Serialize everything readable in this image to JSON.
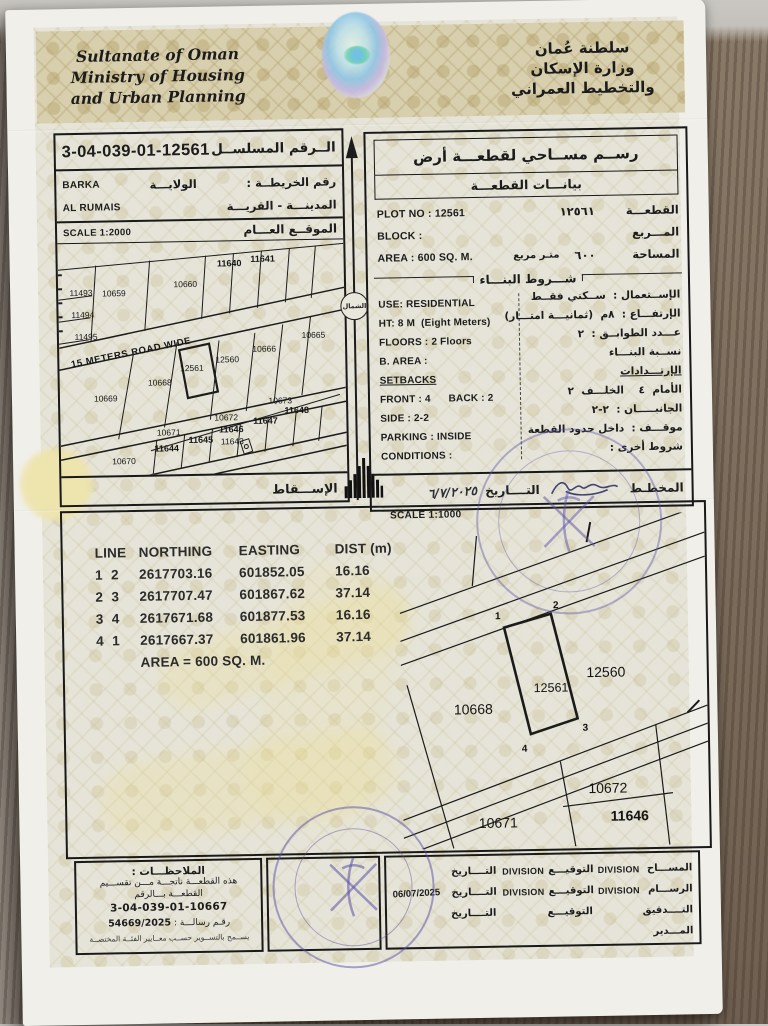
{
  "header": {
    "english_lines": [
      "Sultanate of Oman",
      "Ministry of Housing",
      "and Urban Planning"
    ],
    "arabic_lines": [
      "سلطنة عُمان",
      "وزارة الإسكان",
      "والتخطيط العمراني"
    ]
  },
  "serial_box": {
    "serial_label": "الــرقم المسلســل",
    "serial_value": "3-04-039-01-12561",
    "map_no_label": "رقم الخريطــة :",
    "wilaya_label": "الولايـــة",
    "wilaya_value": "BARKA",
    "town_label": "المدينـــة - القريـــة",
    "town_value": "AL RUMAIS"
  },
  "overview_map": {
    "title": "الموقــع العـــام",
    "scale": "SCALE 1:2000",
    "projection_label": "الإســـقاط",
    "north_label": "الشمال",
    "plots": [
      {
        "label": "11493",
        "x": 8,
        "y": 21
      },
      {
        "label": "11494",
        "x": 8.5,
        "y": 30.5
      },
      {
        "label": "11495",
        "x": 9.5,
        "y": 40
      },
      {
        "label": "10659",
        "x": 19.5,
        "y": 21.5
      },
      {
        "label": "10660",
        "x": 44.5,
        "y": 18
      },
      {
        "label": "11640",
        "x": 60,
        "y": 9.4,
        "bold": true
      },
      {
        "label": "11641",
        "x": 71.7,
        "y": 7.7,
        "bold": true
      },
      {
        "label": "10665",
        "x": 89,
        "y": 40.8
      },
      {
        "label": "10666",
        "x": 71.7,
        "y": 46.4
      },
      {
        "label": "12560",
        "x": 58.7,
        "y": 51
      },
      {
        "label": "12561",
        "x": 46.3,
        "y": 54.5
      },
      {
        "label": "10668",
        "x": 35,
        "y": 60.5
      },
      {
        "label": "10669",
        "x": 16,
        "y": 67
      },
      {
        "label": "10670",
        "x": 22,
        "y": 94
      },
      {
        "label": "10671",
        "x": 37.8,
        "y": 82
      },
      {
        "label": "11644",
        "x": 37,
        "y": 89,
        "bold": true
      },
      {
        "label": "11645",
        "x": 49,
        "y": 85.4,
        "bold": true
      },
      {
        "label": "11643",
        "x": 60,
        "y": 86.3
      },
      {
        "label": "11646",
        "x": 59.7,
        "y": 81,
        "bold": true
      },
      {
        "label": "10672",
        "x": 58,
        "y": 76
      },
      {
        "label": "10673",
        "x": 77,
        "y": 69
      },
      {
        "label": "11647",
        "x": 71.7,
        "y": 77.7,
        "bold": true
      },
      {
        "label": "11648",
        "x": 82.7,
        "y": 73.4,
        "bold": true
      },
      {
        "label": "15 METERS ROAD WIDE",
        "x": 25,
        "y": 47.5,
        "rot": -10.5,
        "road": true
      }
    ]
  },
  "survey_box": {
    "title": "رســم مســاحي لقطعـــة أرض",
    "subtitle": "بيانـــات القطعـــة",
    "plot_label": "القطعـــة",
    "plot_value_ar": "١٢٥٦١",
    "plot_en": "PLOT NO : 12561",
    "block_label": "المـــربع",
    "block_en": "BLOCK :",
    "area_label": "المساحة",
    "area_value_ar": "٦٠٠",
    "area_unit_ar": "متـر مربع",
    "area_en": "AREA : 600 SQ. M.",
    "conditions_header": "شـــروط البنـــاء",
    "en_col": [
      "USE: RESIDENTIAL",
      "HT: 8 M  (Eight Meters)",
      "FLOORS : 2 Floors",
      "B. AREA :",
      "SETBACKS",
      "FRONT : 4      BACK : 2",
      "SIDE : 2-2",
      "PARKING : INSIDE",
      "CONDITIONS :"
    ],
    "ar_col": [
      "الإســتعمال :  ســكني فقــط",
      "الإرتفـــاع :  ٨م  (ثمانيـــة امتـــار)",
      "عـــدد الطوابــق :  ٢",
      "نســبة البنـــاء",
      "الإرتـــدادات",
      "الأمام  ٤    الخلـــف  ٢",
      "الجانبـــــان :  ٢-٢",
      "موقـــف :  داخل حدود القطعة",
      "شروط أخرى :"
    ],
    "planner_label": "المخطـط",
    "date_label": "التــــاريخ",
    "date_value": "٦/٧/٢٠٢٥"
  },
  "coords": {
    "headers": [
      "LINE",
      "NORTHING",
      "EASTING",
      "DIST (m)"
    ],
    "rows": [
      [
        "1",
        "2",
        "2617703.16",
        "601852.05",
        "16.16"
      ],
      [
        "2",
        "3",
        "2617707.47",
        "601867.62",
        "37.14"
      ],
      [
        "3",
        "4",
        "2617671.68",
        "601877.53",
        "16.16"
      ],
      [
        "4",
        "1",
        "2617667.37",
        "601861.96",
        "37.14"
      ]
    ],
    "area_line": "AREA = 600 SQ. M."
  },
  "detail_map": {
    "scale": "SCALE 1:1000",
    "subject": "12561",
    "corners": [
      {
        "label": "1",
        "x": 32,
        "y": 30.5
      },
      {
        "label": "2",
        "x": 51,
        "y": 27.5
      },
      {
        "label": "3",
        "x": 60,
        "y": 64.5
      },
      {
        "label": "4",
        "x": 40,
        "y": 70.5
      }
    ],
    "plots": [
      {
        "label": "10668",
        "x": 23.5,
        "y": 58
      },
      {
        "label": "12561",
        "x": 49,
        "y": 52,
        "small": true
      },
      {
        "label": "12560",
        "x": 67,
        "y": 47.5
      },
      {
        "label": "10672",
        "x": 67,
        "y": 82.5
      },
      {
        "label": "11646",
        "x": 74,
        "y": 91,
        "bold": true
      },
      {
        "label": "10671",
        "x": 31,
        "y": 92.5
      }
    ]
  },
  "footer": {
    "notes_title": "الملاحظـــات :",
    "notes_lines": [
      "هذه القطعـــة ناتجـــة مـــن تقســـيم",
      "القطعـــة بـــالرقم"
    ],
    "parent_serial": "3-04-039-01-10667",
    "letter_label": "رقـم رسالـــة :",
    "letter_value": "54669/2025",
    "notes_small": "يســمح بالتســوير حســب معــايير الفئــة المختصــة",
    "sign_rows": [
      {
        "role": "المســـاح",
        "div1": "DIVISION",
        "sig": "التوقيـــع",
        "div2": "DIVISION",
        "date_l": "التــــاريخ",
        "date": ""
      },
      {
        "role": "الرســـام",
        "div1": "DIVISION",
        "sig": "التوقيـــع",
        "div2": "DIVISION",
        "date_l": "التــــاريخ",
        "date": "06/07/2025"
      },
      {
        "role": "التــــدقيق",
        "div1": "",
        "sig": "التوقيـــع",
        "div2": "",
        "date_l": "التــــاريخ",
        "date": ""
      },
      {
        "role": "المـــدير",
        "div1": "",
        "sig": "",
        "div2": "",
        "date_l": "",
        "date": ""
      }
    ]
  }
}
